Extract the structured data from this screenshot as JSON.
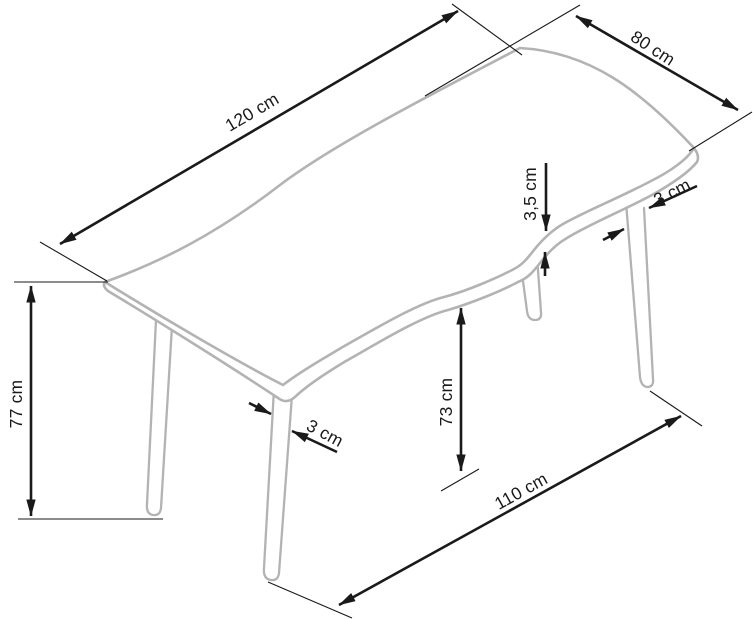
{
  "page": {
    "title": "Table dimension technical drawing",
    "background": "#ffffff"
  },
  "drawing": {
    "object": "dining table with wavy-edge top and four tapered legs, isometric line drawing",
    "unit": "cm",
    "labels": {
      "length": "120 cm",
      "width": "80 cm",
      "height": "77 cm",
      "top_thickness": "3,5 cm",
      "leg_thickness_front_right": "3 cm",
      "leg_thickness_front_left": "3 cm",
      "clearance_height": "73 cm",
      "leg_span": "110 cm"
    },
    "values": {
      "length_cm": 120,
      "width_cm": 80,
      "height_cm": 77,
      "top_thickness_cm": 3.5,
      "leg_thickness_cm": 3,
      "clearance_height_cm": 73,
      "leg_span_cm": 110
    },
    "colors": {
      "dimension": "#1a1a1a",
      "table": "#b3b3b3",
      "background": "#ffffff"
    }
  }
}
